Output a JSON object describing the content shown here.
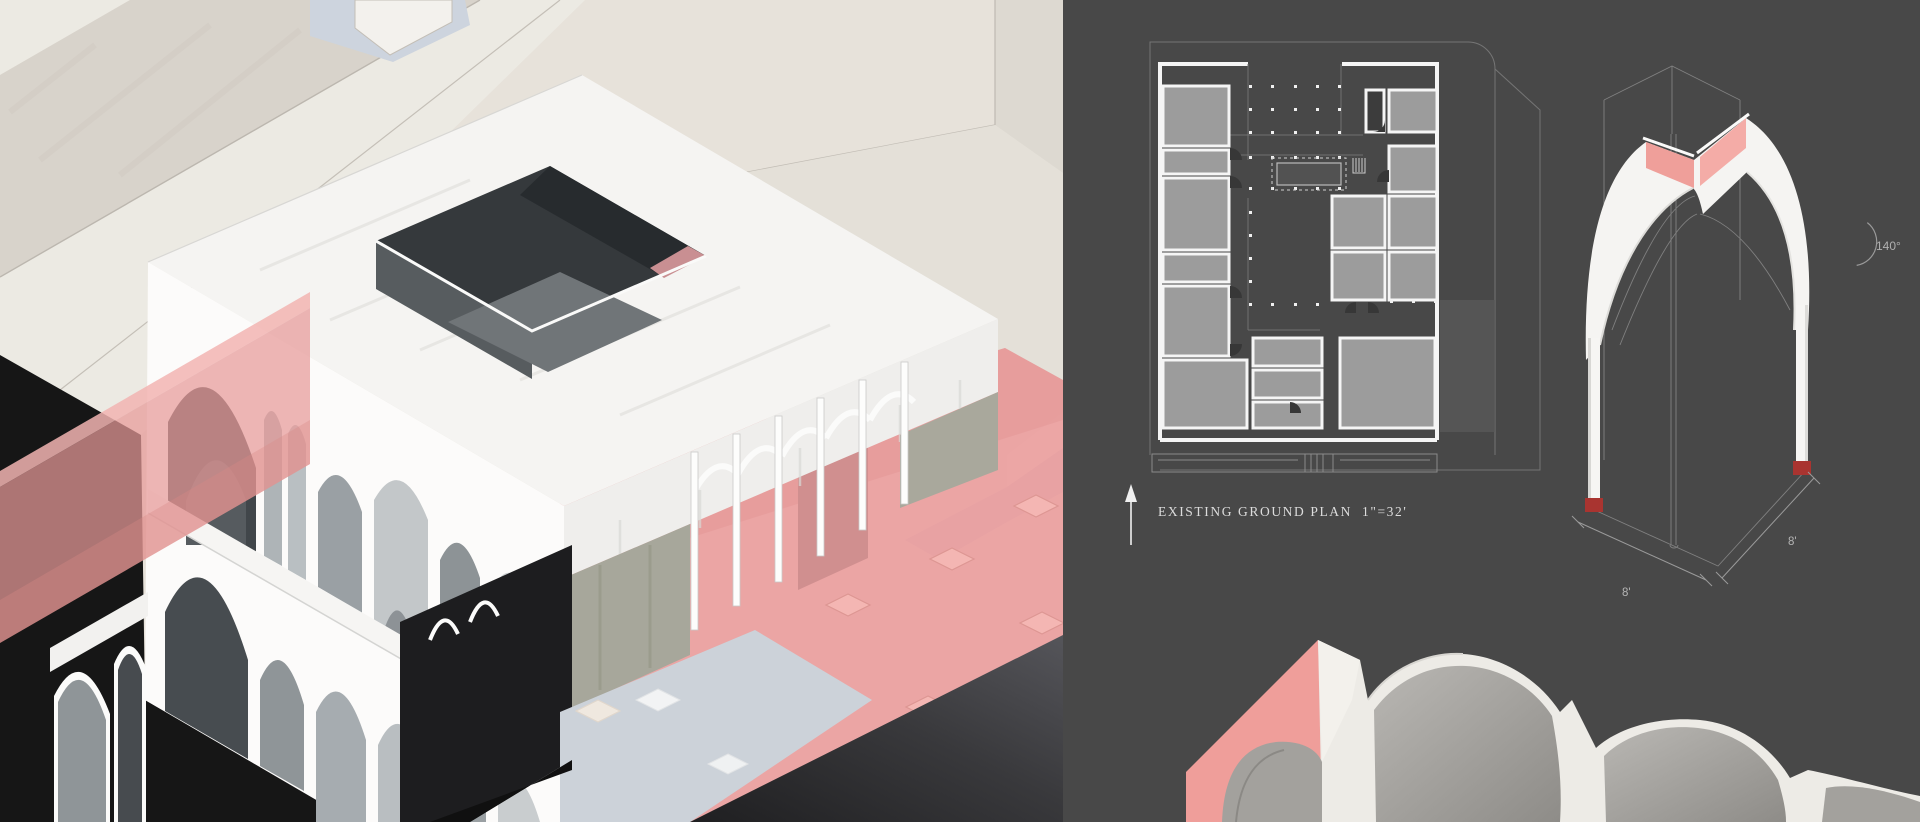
{
  "board": {
    "kind": "architectural presentation board",
    "left_section": "site axonometric rendering with arched pavilion, pink light beams and context buildings",
    "right_section": "dark drawing panel with existing ground plan, vault module axonometric and vault close-up"
  },
  "plan": {
    "label": "EXISTING GROUND PLAN",
    "scale": "1\"=32'",
    "north_icon": "north-arrow-icon"
  },
  "arch_detail": {
    "angle_label": "140°",
    "dim_left": "8'",
    "dim_right": "8'"
  },
  "palette": {
    "panel-bg": "#484848",
    "beige": "#e7e2da",
    "beige-dark": "#d8d3cb",
    "beige-light": "#eceae3",
    "blue-street": "#b8bec9",
    "blue-alley": "#cdd4de",
    "pink": "#e89a98",
    "pink-plaza": "#eb9f9f",
    "pink-tile": "#f4b6b3",
    "pink-roofband": "#ef9f9a",
    "pink-wall-dark": "#d08f8f",
    "red-base": "#a93430",
    "roof-white": "#f5f4f2",
    "wall-white": "#fcfbfa",
    "gray-green": "#a7a79b",
    "ink-black": "#161616",
    "street-dark": "#39393c",
    "room-gray": "#9c9c9c",
    "line-faint": "#7d7d7d"
  }
}
